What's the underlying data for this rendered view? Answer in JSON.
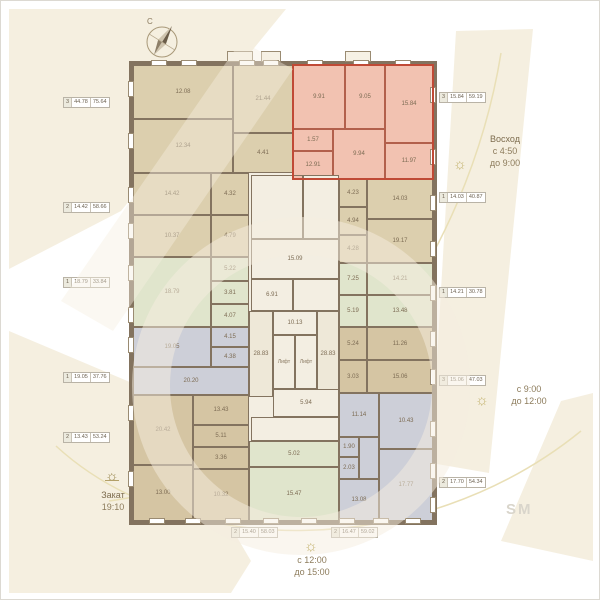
{
  "meta": {
    "north_label": "С",
    "brand_watermark": "SM",
    "sun_icon": "☼"
  },
  "annotations": {
    "sunrise": {
      "title": "Восход",
      "from": "с 4:50",
      "to": "до 9:00"
    },
    "morning": {
      "from": "с 9:00",
      "to": "до 12:00"
    },
    "noon": {
      "from": "с 12:00",
      "to": "до 15:00"
    },
    "sunset": {
      "title": "Закат",
      "time": "19:10"
    }
  },
  "palette": {
    "wall": "#83735f",
    "beige": "#dccfae",
    "tan": "#d5c5a3",
    "pink": "#f2c2b1",
    "pink_wall": "#b2604c",
    "highlight_border": "#c04a36",
    "gray": "#cdcfd8",
    "green": "#e0e5cc",
    "core": "#f3eee2",
    "corridor": "#eee8d8",
    "window_frame": "#9a8b72",
    "text": "#7d6c54",
    "arc": "#e9dfb6",
    "wash": "#f5efe0"
  },
  "plan": {
    "apartments": [
      {
        "id": "apt-top-left",
        "color": "beige",
        "rooms": [
          [
            132,
            64,
            100,
            54,
            "12.08"
          ],
          [
            132,
            118,
            100,
            54,
            "12.34"
          ],
          [
            232,
            64,
            60,
            68,
            "21.44"
          ],
          [
            232,
            132,
            60,
            40,
            "4.41"
          ]
        ]
      },
      {
        "id": "apt-top-right-highlighted",
        "color": "pink",
        "wall": "pink_wall",
        "highlight": true,
        "bbox": [
          291,
          63,
          142,
          116
        ],
        "rooms": [
          [
            292,
            64,
            52,
            64,
            "9.91"
          ],
          [
            344,
            64,
            40,
            64,
            "9.05"
          ],
          [
            384,
            64,
            48,
            78,
            "15.84"
          ],
          [
            292,
            128,
            40,
            22,
            "1.57"
          ],
          [
            292,
            150,
            40,
            28,
            "12.91"
          ],
          [
            332,
            128,
            52,
            50,
            "9.94"
          ],
          [
            384,
            142,
            48,
            36,
            "11.97"
          ]
        ]
      },
      {
        "id": "apt-left-2",
        "color": "beige",
        "rooms": [
          [
            132,
            172,
            78,
            42,
            "14.42"
          ],
          [
            132,
            214,
            78,
            42,
            "10.37"
          ],
          [
            210,
            172,
            38,
            42,
            "4.32"
          ],
          [
            210,
            214,
            38,
            42,
            "4.79"
          ]
        ]
      },
      {
        "id": "apt-left-3",
        "color": "green",
        "rooms": [
          [
            132,
            256,
            78,
            70,
            "18.79"
          ],
          [
            210,
            256,
            38,
            24,
            "5.22"
          ],
          [
            210,
            280,
            38,
            23,
            "3.81"
          ],
          [
            210,
            303,
            38,
            23,
            "4.07"
          ]
        ]
      },
      {
        "id": "apt-left-4",
        "color": "gray",
        "rooms": [
          [
            132,
            326,
            78,
            40,
            "19.05"
          ],
          [
            210,
            326,
            38,
            20,
            "4.15"
          ],
          [
            210,
            346,
            38,
            20,
            "4.38"
          ],
          [
            132,
            366,
            116,
            28,
            "20.20"
          ]
        ]
      },
      {
        "id": "apt-bottom-left",
        "color": "tan",
        "rooms": [
          [
            132,
            394,
            60,
            70,
            "20.42"
          ],
          [
            192,
            394,
            56,
            30,
            "13.43"
          ],
          [
            192,
            424,
            56,
            22,
            "5.11"
          ],
          [
            192,
            446,
            56,
            22,
            "3.36"
          ],
          [
            132,
            464,
            60,
            56,
            "13.00"
          ],
          [
            192,
            468,
            56,
            52,
            "10.32"
          ]
        ]
      },
      {
        "id": "apt-bottom-center",
        "color": "green",
        "rooms": [
          [
            248,
            440,
            90,
            26,
            "5.02"
          ],
          [
            248,
            466,
            90,
            54,
            "15.47"
          ]
        ]
      },
      {
        "id": "apt-right-2",
        "color": "beige",
        "rooms": [
          [
            338,
            178,
            28,
            28,
            "4.23"
          ],
          [
            338,
            206,
            28,
            28,
            "4.94"
          ],
          [
            338,
            234,
            28,
            28,
            "4.28"
          ],
          [
            366,
            178,
            66,
            40,
            "14.03"
          ],
          [
            366,
            218,
            66,
            44,
            "19.17"
          ]
        ]
      },
      {
        "id": "apt-right-3",
        "color": "green",
        "rooms": [
          [
            338,
            262,
            28,
            32,
            "7.25"
          ],
          [
            338,
            294,
            28,
            32,
            "5.19"
          ],
          [
            366,
            262,
            66,
            32,
            "14.21"
          ],
          [
            366,
            294,
            66,
            32,
            "13.48"
          ]
        ]
      },
      {
        "id": "apt-right-4",
        "color": "tan",
        "rooms": [
          [
            338,
            326,
            28,
            33,
            "5.24"
          ],
          [
            338,
            359,
            28,
            33,
            "3.03"
          ],
          [
            366,
            326,
            66,
            33,
            "11.26"
          ],
          [
            366,
            359,
            66,
            33,
            "15.06"
          ]
        ]
      },
      {
        "id": "apt-bottom-right",
        "color": "gray",
        "rooms": [
          [
            338,
            392,
            40,
            44,
            "11.14"
          ],
          [
            338,
            436,
            20,
            20,
            "1.90"
          ],
          [
            338,
            456,
            20,
            22,
            "2.03"
          ],
          [
            358,
            436,
            20,
            42,
            ""
          ],
          [
            378,
            392,
            54,
            56,
            "10.43"
          ],
          [
            378,
            448,
            54,
            72,
            "17.77"
          ],
          [
            338,
            478,
            40,
            42,
            "13.08"
          ]
        ]
      }
    ],
    "core": {
      "bbox": [
        248,
        172,
        90,
        268
      ],
      "rooms": [
        [
          250,
          174,
          52,
          64,
          "",
          "stairs"
        ],
        [
          302,
          174,
          36,
          64,
          ""
        ],
        [
          250,
          238,
          88,
          40,
          "15.09"
        ],
        [
          250,
          278,
          42,
          32,
          "6.91"
        ],
        [
          292,
          278,
          46,
          32,
          ""
        ],
        [
          248,
          310,
          24,
          86,
          "28.83"
        ],
        [
          272,
          310,
          44,
          24,
          "10.13"
        ],
        [
          272,
          334,
          22,
          54,
          "Лифт",
          "lift"
        ],
        [
          294,
          334,
          22,
          54,
          "Лифт",
          "lift"
        ],
        [
          316,
          310,
          22,
          86,
          "28.83"
        ],
        [
          272,
          388,
          66,
          28,
          "5.94"
        ],
        [
          250,
          416,
          88,
          24,
          ""
        ]
      ]
    },
    "windows": [
      [
        150,
        59,
        16,
        6
      ],
      [
        180,
        59,
        16,
        6
      ],
      [
        238,
        59,
        16,
        6
      ],
      [
        262,
        59,
        16,
        6
      ],
      [
        306,
        59,
        16,
        6
      ],
      [
        352,
        59,
        16,
        6
      ],
      [
        394,
        59,
        16,
        6
      ],
      [
        127,
        80,
        6,
        16
      ],
      [
        127,
        132,
        6,
        16
      ],
      [
        127,
        186,
        6,
        16
      ],
      [
        127,
        222,
        6,
        16
      ],
      [
        127,
        264,
        6,
        16
      ],
      [
        127,
        306,
        6,
        16
      ],
      [
        127,
        336,
        6,
        16
      ],
      [
        127,
        404,
        6,
        16
      ],
      [
        127,
        470,
        6,
        16
      ],
      [
        148,
        517,
        16,
        6
      ],
      [
        184,
        517,
        16,
        6
      ],
      [
        224,
        517,
        16,
        6
      ],
      [
        262,
        517,
        16,
        6
      ],
      [
        300,
        517,
        16,
        6
      ],
      [
        338,
        517,
        16,
        6
      ],
      [
        372,
        517,
        16,
        6
      ],
      [
        404,
        517,
        16,
        6
      ],
      [
        429,
        86,
        6,
        16
      ],
      [
        429,
        148,
        6,
        16
      ],
      [
        429,
        194,
        6,
        16
      ],
      [
        429,
        240,
        6,
        16
      ],
      [
        429,
        284,
        6,
        16
      ],
      [
        429,
        330,
        6,
        16
      ],
      [
        429,
        368,
        6,
        16
      ],
      [
        429,
        420,
        6,
        16
      ],
      [
        429,
        462,
        6,
        16
      ],
      [
        429,
        496,
        6,
        16
      ]
    ],
    "balconies": [
      [
        226,
        50,
        26,
        11
      ],
      [
        260,
        50,
        20,
        11
      ],
      [
        344,
        50,
        26,
        11
      ]
    ],
    "unit_labels": [
      {
        "x": 62,
        "y": 96,
        "cells": [
          "3",
          "44.78",
          "75.64"
        ]
      },
      {
        "x": 62,
        "y": 201,
        "cells": [
          "2",
          "14.42",
          "58.66"
        ]
      },
      {
        "x": 62,
        "y": 276,
        "cells": [
          "1",
          "18.79",
          "33.84"
        ]
      },
      {
        "x": 62,
        "y": 371,
        "cells": [
          "1",
          "19.05",
          "37.76"
        ]
      },
      {
        "x": 62,
        "y": 431,
        "cells": [
          "2",
          "13.43",
          "53.24"
        ]
      },
      {
        "x": 438,
        "y": 91,
        "cells": [
          "3",
          "15.84",
          "59.19"
        ]
      },
      {
        "x": 438,
        "y": 191,
        "cells": [
          "1",
          "14.03",
          "40.87"
        ]
      },
      {
        "x": 438,
        "y": 286,
        "cells": [
          "1",
          "14.21",
          "30.78"
        ]
      },
      {
        "x": 438,
        "y": 374,
        "cells": [
          "3",
          "15.06",
          "47.03"
        ]
      },
      {
        "x": 438,
        "y": 476,
        "cells": [
          "2",
          "17.70",
          "54.34"
        ]
      },
      {
        "x": 230,
        "y": 526,
        "cells": [
          "2",
          "15.40",
          "58.03"
        ]
      },
      {
        "x": 330,
        "y": 526,
        "cells": [
          "2",
          "16.47",
          "59.02"
        ]
      }
    ]
  }
}
